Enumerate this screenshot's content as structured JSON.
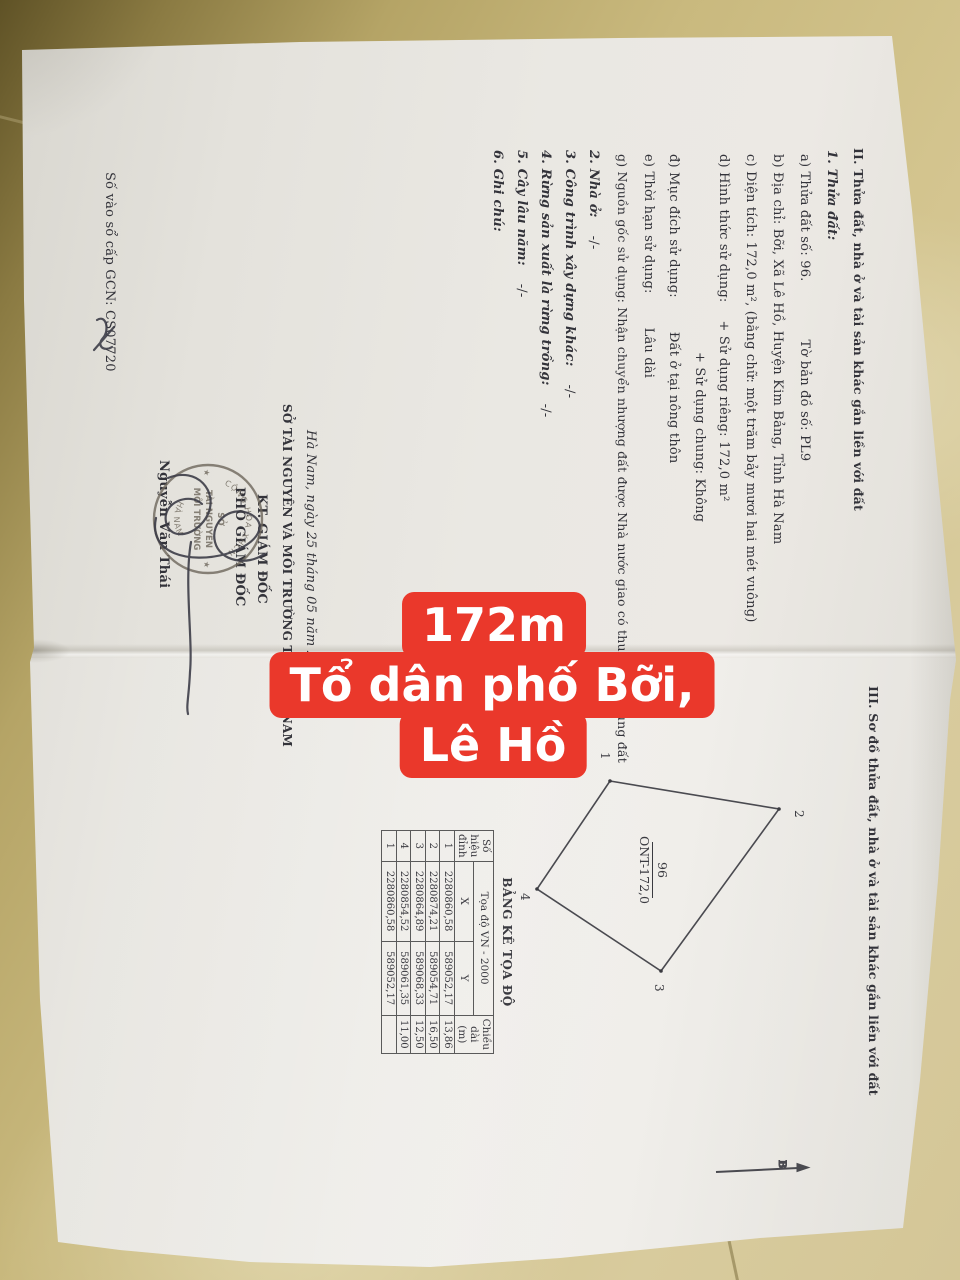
{
  "red_label": {
    "color": "#ea382b",
    "line1": "172m",
    "line2": "Tổ dân phố Bỡi,",
    "line3": "Lê Hồ"
  },
  "section2": {
    "heading": "II. Thửa đất, nhà ở và tài sản khác gắn liền với đất",
    "sub1": "1. Thửa đất:",
    "a1": "a) Thửa đất số: 96.",
    "a2": "Tờ bản đồ số: PL9",
    "b": "b) Địa chỉ: Bỡi, Xã Lê Hồ, Huyện Kim Bảng, Tỉnh Hà Nam",
    "c": "c) Diện tích: 172,0 m², (bằng chữ: một trăm bảy mươi hai mét vuông)",
    "d1": "d) Hình thức sử dụng:",
    "d2": "+ Sử dụng riêng: 172,0 m²",
    "d3": "+ Sử dụng chung: Không",
    "dd1": "đ) Mục đích sử dụng:",
    "dd2": "Đất ở tại nông thôn",
    "e1": "e) Thời hạn sử dụng:",
    "e2": "Lâu dài",
    "g": "g) Nguồn gốc sử dụng: Nhận chuyển nhượng đất được Nhà nước giao có thu tiền sử dụng đất",
    "s2": "2. Nhà ở:",
    "s3": "3. Công trình xây dựng khác:",
    "s4": "4. Rừng sản xuất là rừng trồng:",
    "s5": "5. Cây lâu năm:",
    "s6": "6. Ghi chú:",
    "none_mark": "-/-"
  },
  "signing": {
    "date_line": "Hà Nam, ngày 25 tháng 05 năm 2020",
    "dept": "SỞ TÀI NGUYÊN VÀ MÔI TRƯỜNG TỈNH HÀ NAM",
    "kt": "KT. GIÁM ĐỐC",
    "role": "PHÓ GIÁM ĐỐC",
    "name": "Nguyễn Văn Thái",
    "book_no": "Số vào sổ cấp GCN: CS07720"
  },
  "stamp": {
    "ring_top": "CỘNG HÒA XHCN",
    "ring_bottom": "HÀ NAM",
    "center1": "SỞ",
    "center2": "TÀI NGUYÊN",
    "center3": "MÔI TRƯỜNG",
    "star_left": "★",
    "star_right": "★"
  },
  "section3": {
    "heading": "III. Sơ đồ thửa đất, nhà ở và tài sản khác gắn liền với đất",
    "parcel": {
      "number": "96",
      "code": "ONT-172,0"
    },
    "north_label": "B",
    "table": {
      "title": "BẢNG KÊ TỌA ĐỘ",
      "col_vertex_1": "Số hiệu",
      "col_vertex_2": "đỉnh",
      "col_coord": "Tọa độ VN - 2000",
      "col_x": "X",
      "col_y": "Y",
      "col_len_1": "Chiều dài",
      "col_len_2": "(m)",
      "rows": [
        [
          "1",
          "2280860,58",
          "589052,17",
          "13,86"
        ],
        [
          "2",
          "2280874,21",
          "589054,71",
          "16,50"
        ],
        [
          "3",
          "2280864,89",
          "589068,33",
          "12,50"
        ],
        [
          "4",
          "2280854,52",
          "589061,35",
          "11,00"
        ],
        [
          "1",
          "2280860,58",
          "589052,17",
          ""
        ]
      ]
    },
    "diagram": {
      "vertices": [
        {
          "label": "1",
          "x": 610,
          "y": 781,
          "lx": 601,
          "ly": 752
        },
        {
          "label": "2",
          "x": 779,
          "y": 809,
          "lx": 795,
          "ly": 810
        },
        {
          "label": "3",
          "x": 661,
          "y": 971,
          "lx": 655,
          "ly": 984
        },
        {
          "label": "4",
          "x": 537,
          "y": 889,
          "lx": 521,
          "ly": 893
        }
      ]
    }
  }
}
